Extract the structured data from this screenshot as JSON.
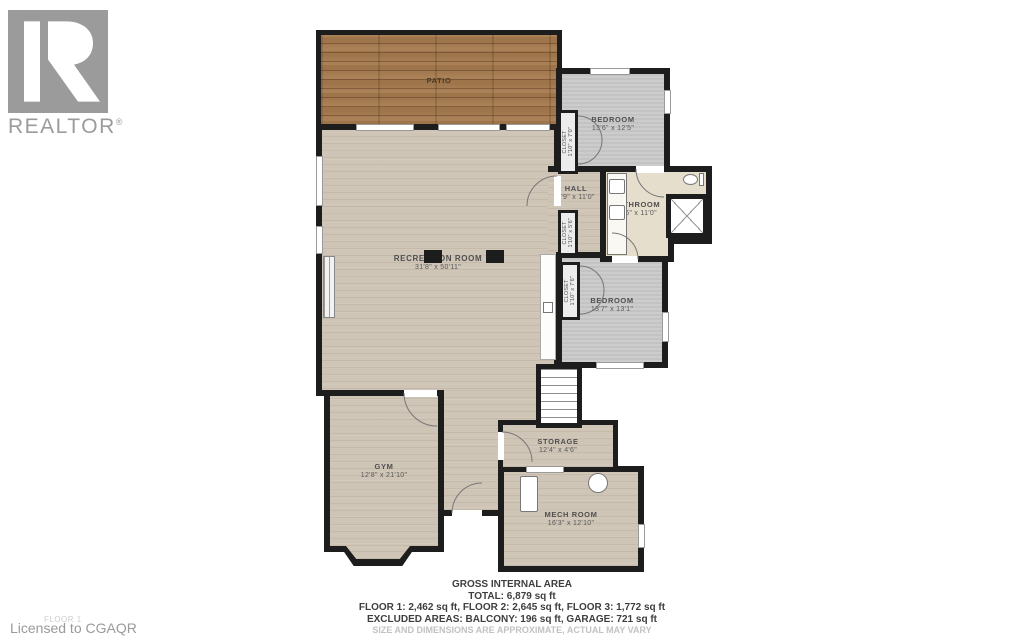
{
  "logo": {
    "brand": "REALTOR",
    "mark": "®"
  },
  "watermark": {
    "floor_label": "FLOOR 1",
    "licensed_to": "Licensed to CGAQR"
  },
  "rooms": {
    "patio": {
      "name": "PATIO",
      "dims": ""
    },
    "bedroom1": {
      "name": "BEDROOM",
      "dims": "13'6\" x 12'5\""
    },
    "closet1": {
      "name": "CLOSET",
      "dims": "1'10\" x 7'0\""
    },
    "hall": {
      "name": "HALL",
      "dims": "5'9\" x 11'0\""
    },
    "bathroom": {
      "name": "BATHROOM",
      "dims": "12'6\" x 11'0\""
    },
    "closet2": {
      "name": "CLOSET",
      "dims": "1'10\" x 5'6\""
    },
    "recreation": {
      "name": "RECREATION ROOM",
      "dims": "31'8\" x 50'11\""
    },
    "closet3": {
      "name": "CLOSET",
      "dims": "1'10\" x 7'6\""
    },
    "bedroom2": {
      "name": "BEDROOM",
      "dims": "13'7\" x 13'1\""
    },
    "gym": {
      "name": "GYM",
      "dims": "12'8\" x 21'10\""
    },
    "storage": {
      "name": "STORAGE",
      "dims": "12'4\" x 4'6\""
    },
    "mech": {
      "name": "MECH ROOM",
      "dims": "16'3\" x 12'10\""
    }
  },
  "area_summary": {
    "title": "GROSS INTERNAL AREA",
    "total": "TOTAL: 6,879 sq ft",
    "floors": "FLOOR 1: 2,462 sq ft, FLOOR 2: 2,645 sq ft, FLOOR 3: 1,772 sq ft",
    "excluded": "EXCLUDED AREAS: BALCONY: 196 sq ft, GARAGE: 721 sq ft",
    "disclaimer": "SIZE AND DIMENSIONS ARE APPROXIMATE, ACTUAL MAY VARY"
  },
  "palette": {
    "wall": "#1d1d1d",
    "wood_floor": "#cfc5b6",
    "patio_wood": "#a67a4e",
    "carpet": "#c9c9c9",
    "tile": "#e6decc",
    "logo_gray": "#9b9b9b"
  }
}
